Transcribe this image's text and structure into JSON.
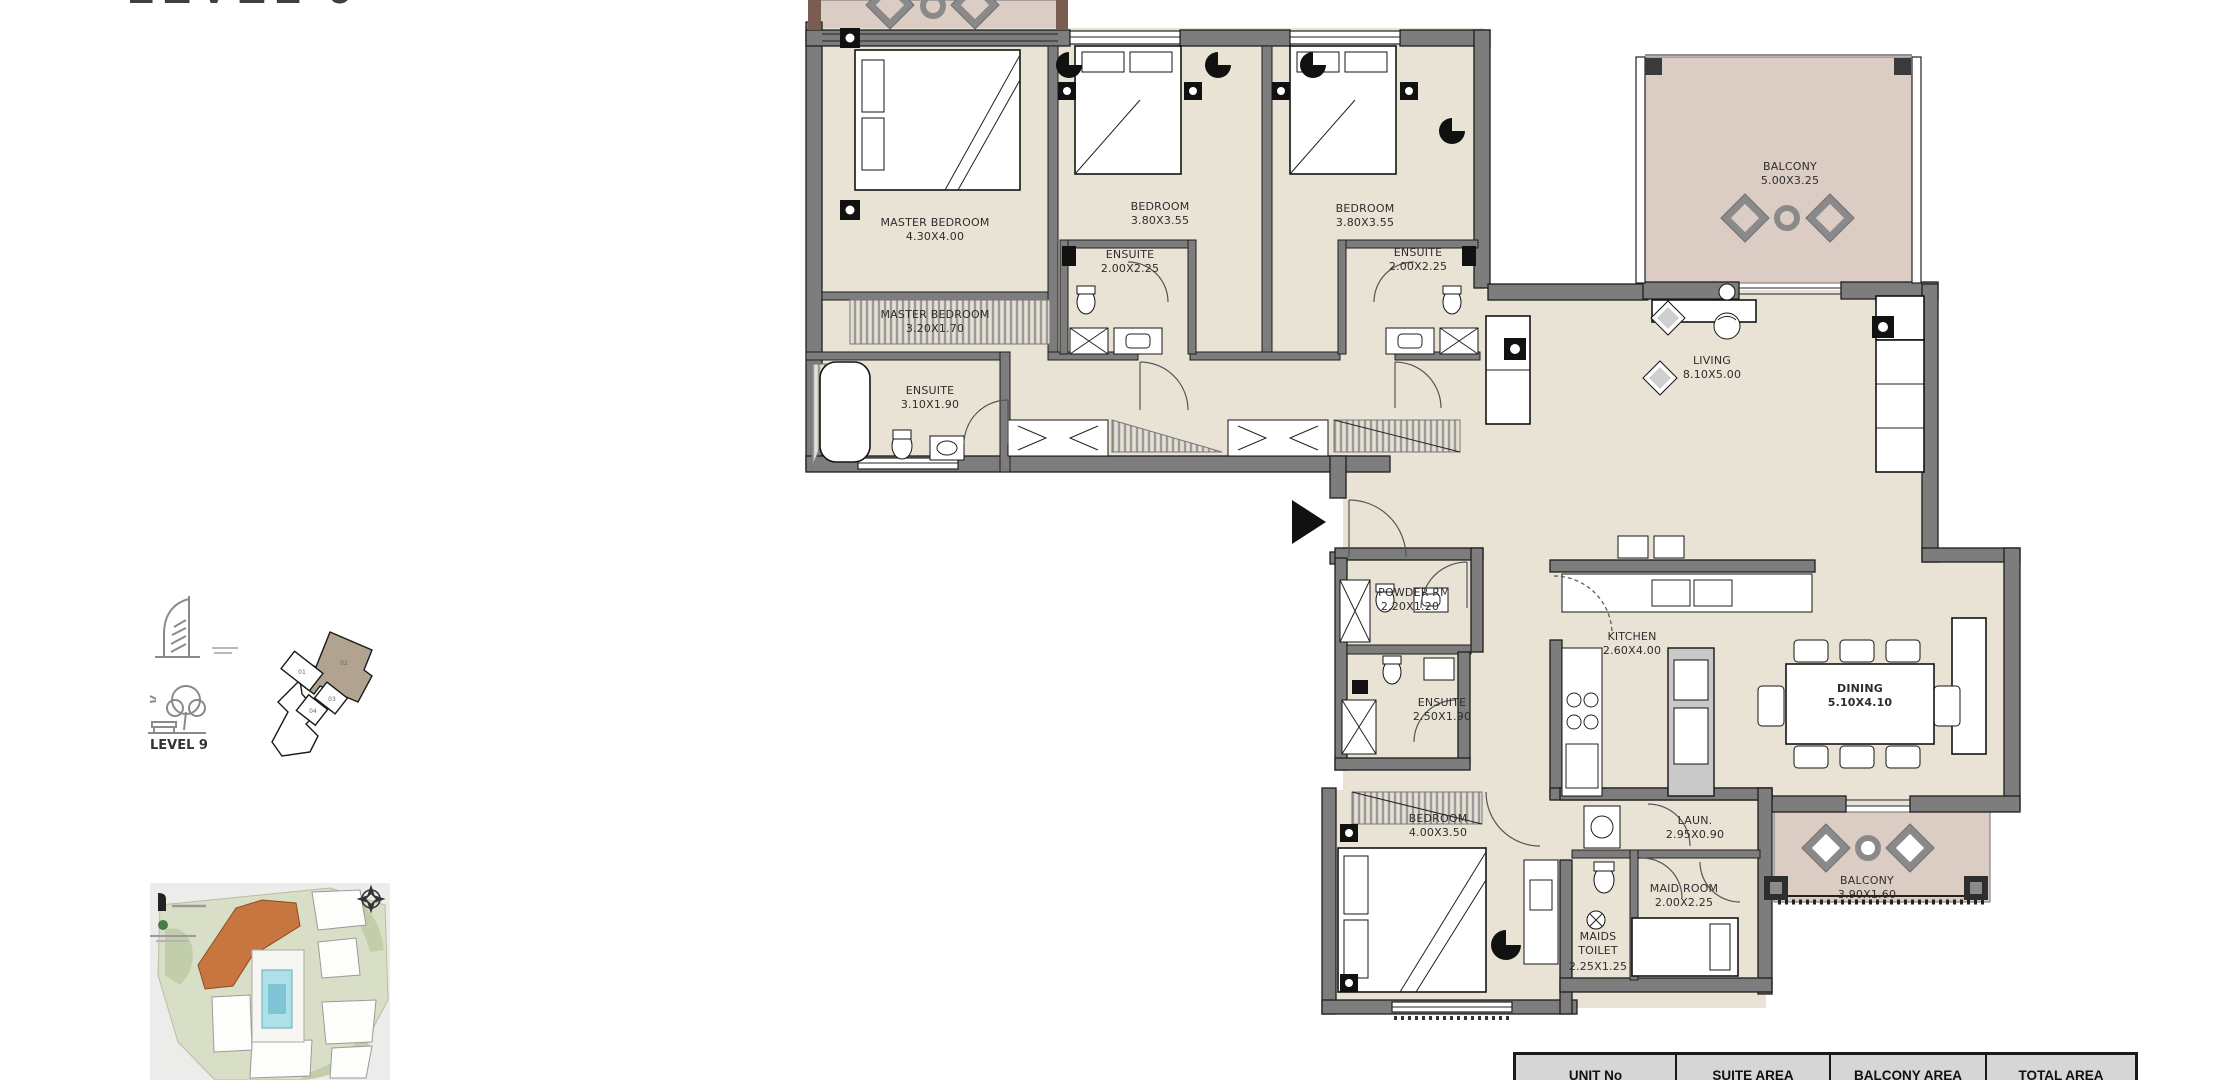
{
  "page": {
    "title": "LEVEL 9"
  },
  "key_plan": {
    "level_label": "LEVEL 9",
    "units": {
      "u01": "01",
      "u02": "02",
      "u03": "03",
      "u04": "04"
    },
    "highlight_color": "#b2a391"
  },
  "rooms": {
    "master_bedroom": {
      "name": "MASTER BEDROOM",
      "dims": "4.30X4.00"
    },
    "master_bedroom_2": {
      "name": "MASTER BEDROOM",
      "dims": "3.20X1.70"
    },
    "master_ensuite": {
      "name": "ENSUITE",
      "dims": "3.10X1.90"
    },
    "bedroom_2": {
      "name": "BEDROOM",
      "dims": "3.80X3.55"
    },
    "ensuite_2": {
      "name": "ENSUITE",
      "dims": "2.00X2.25"
    },
    "bedroom_3": {
      "name": "BEDROOM",
      "dims": "3.80X3.55"
    },
    "ensuite_3": {
      "name": "ENSUITE",
      "dims": "2.00X2.25"
    },
    "balcony_top": {
      "name": "BALCONY",
      "dims": "5.00X3.25"
    },
    "living": {
      "name": "LIVING",
      "dims": "8.10X5.00"
    },
    "powder": {
      "name": "POWDER RM",
      "dims": "2.20X1.20"
    },
    "ensuite_4": {
      "name": "ENSUITE",
      "dims": "2.50X1.90"
    },
    "kitchen": {
      "name": "KITCHEN",
      "dims": "2.60X4.00"
    },
    "dining": {
      "name": "DINING",
      "dims": "5.10X4.10"
    },
    "bedroom_4": {
      "name": "BEDROOM",
      "dims": "4.00X3.50"
    },
    "laundry": {
      "name": "LAUN.",
      "dims": "2.95X0.90"
    },
    "maid_room": {
      "name": "MAID ROOM",
      "dims": "2.00X2.25"
    },
    "maids_toilet": {
      "line1": "MAIDS",
      "line2": "TOILET",
      "dims": "2.25X1.25"
    },
    "balcony_bottom": {
      "name": "BALCONY",
      "dims": "3.90X1.60"
    }
  },
  "area_table": {
    "headers": [
      "UNIT No",
      "SUITE AREA",
      "BALCONY AREA",
      "TOTAL AREA"
    ]
  },
  "colors": {
    "floor": "#e9e3d5",
    "balcony": "#dccdc4",
    "wall": "#7d7d7d",
    "site_highlight": "#c8763f",
    "pool": "#aee0e8",
    "key_highlight": "#b2a391",
    "table_header_bg": "#d6d6d6"
  }
}
